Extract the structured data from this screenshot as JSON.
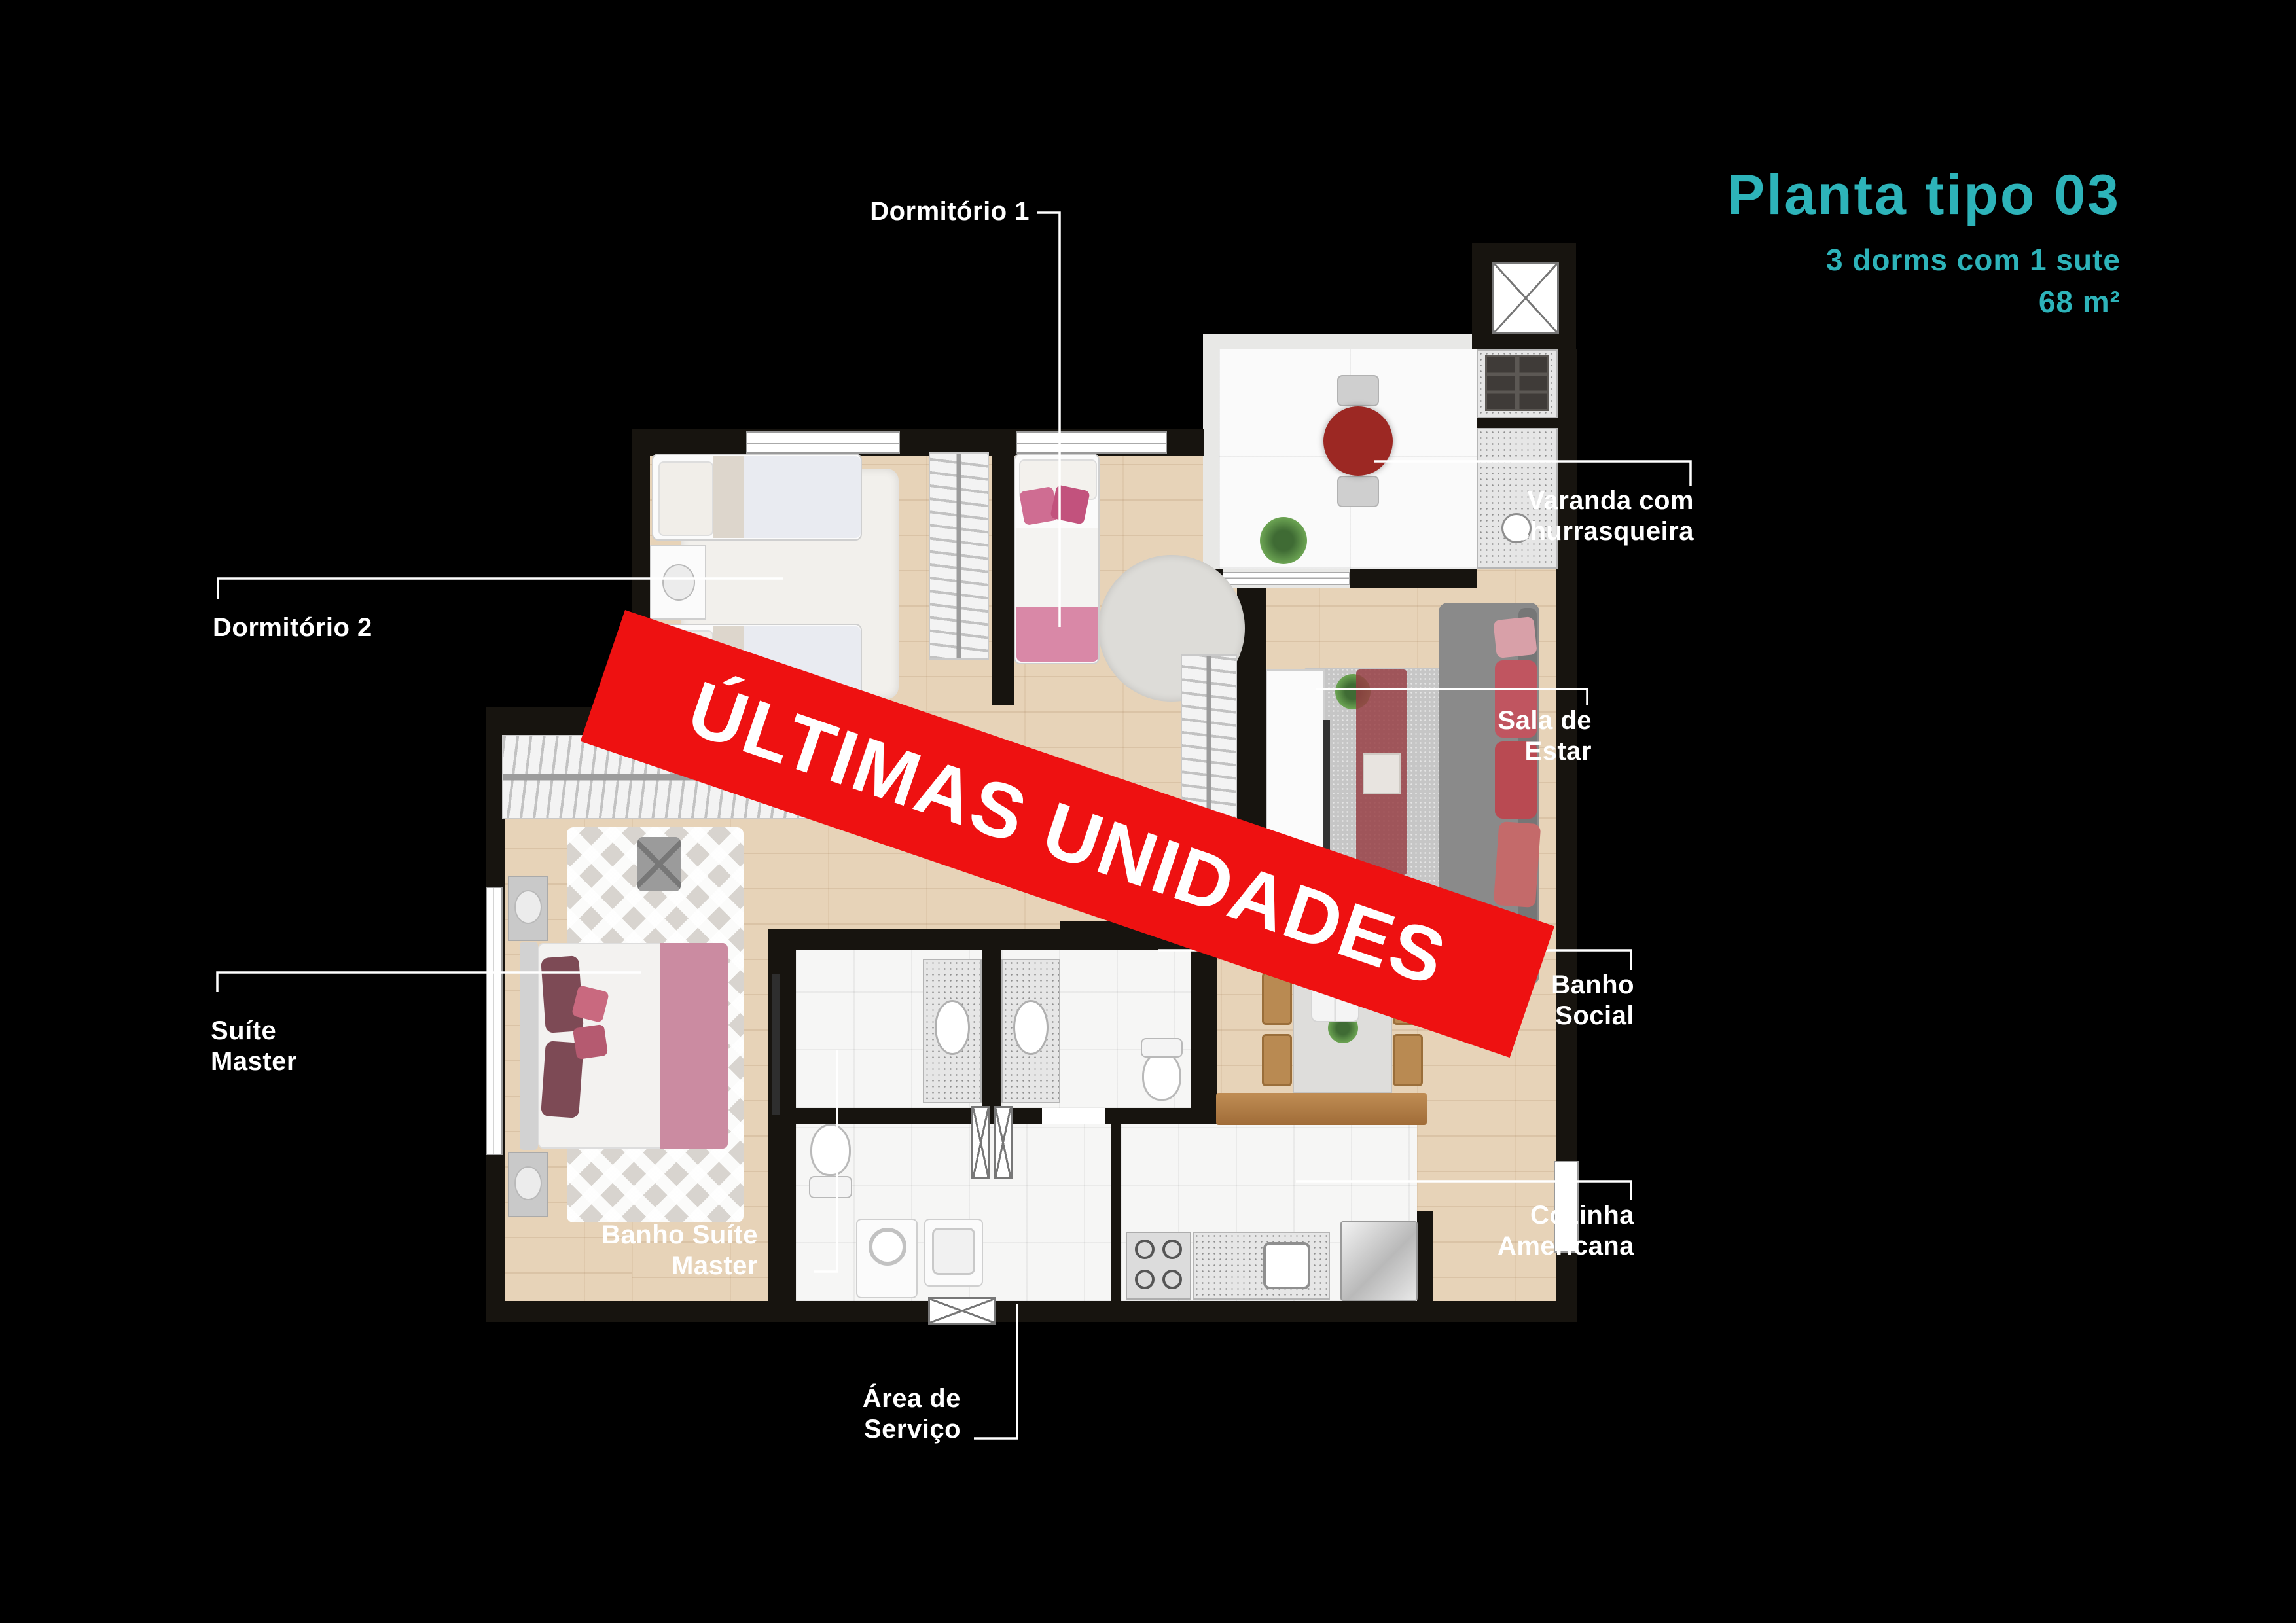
{
  "header": {
    "title": "Planta tipo 03",
    "subtitle": "3 dorms com 1 sute",
    "area": "68 m²",
    "accent_color": "#2db3b9"
  },
  "banner": {
    "text": "ÚLTIMAS UNIDADES",
    "color": "#ee1111"
  },
  "rooms": {
    "dormitorio_1": {
      "label": "Dormitório 1"
    },
    "dormitorio_2": {
      "label": "Dormitório 2"
    },
    "suite_master": {
      "line1": "Suíte",
      "line2": "Master"
    },
    "banho_suite_master": {
      "line1": "Banho Suíte",
      "line2": "Master"
    },
    "area_servico": {
      "line1": "Área de",
      "line2": "Serviço"
    },
    "varanda": {
      "line1": "Varanda com",
      "line2": "churrasqueira"
    },
    "sala_estar": {
      "line1": "Sala de",
      "line2": "Estar"
    },
    "banho_social": {
      "line1": "Banho",
      "line2": "Social"
    },
    "cozinha": {
      "line1": "Cozinha",
      "line2": "Americana"
    }
  }
}
